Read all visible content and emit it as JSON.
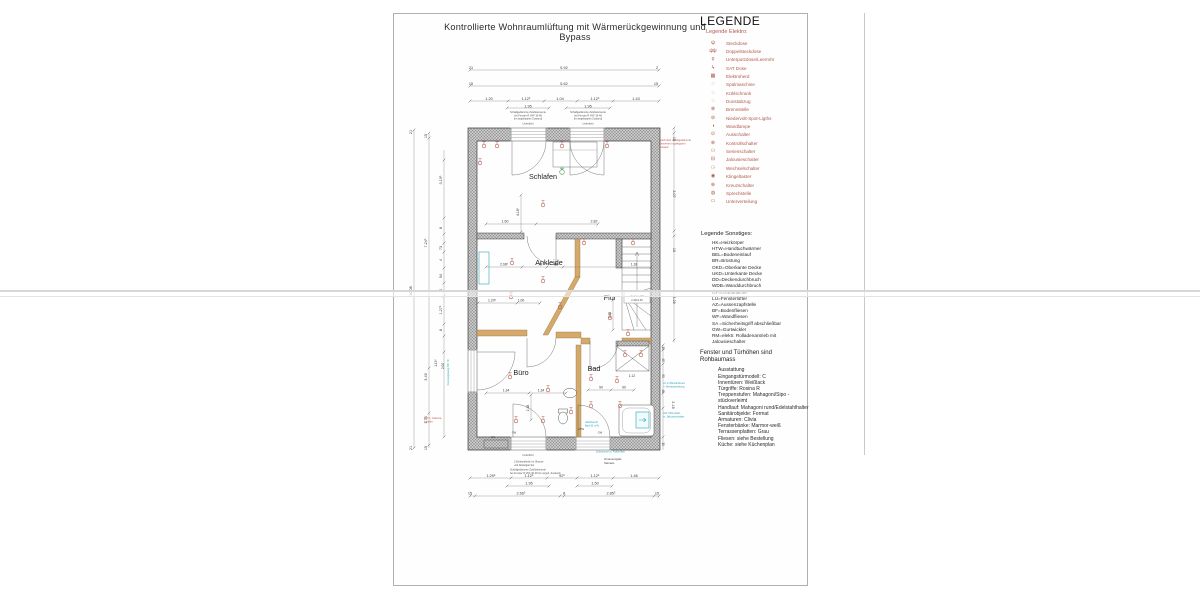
{
  "sheet": {
    "title": "Kontrollierte Wohnraumlüftung mit Wärmerückgewinnung und Bypass"
  },
  "legend": {
    "heading": "LEGENDE",
    "elektro_heading": "Legende Elektro:",
    "elektro_color": "#b0584c",
    "elektro_items": [
      {
        "symbol": "ψ",
        "label": "Steckdose"
      },
      {
        "symbol": "ψψ",
        "label": "Doppelsteckdose"
      },
      {
        "symbol": "ϙ",
        "label": "Unterputzdose/Leerrohr"
      },
      {
        "symbol": "ϟ",
        "label": "SAT Dose"
      },
      {
        "symbol": "▦",
        "label": "Elektroherd"
      },
      {
        "symbol": "◌",
        "label": "Spülmaschine"
      },
      {
        "symbol": "◌",
        "label": "Kühlschrank"
      },
      {
        "symbol": "◌",
        "label": "Dunstabzug"
      },
      {
        "symbol": "⊗",
        "label": "Brennstelle"
      },
      {
        "symbol": "⊘",
        "label": "Niedervolt-Spot-Ligths"
      },
      {
        "symbol": "◑",
        "label": "Wandlampe"
      },
      {
        "symbol": "⊙",
        "label": "Ausschalter"
      },
      {
        "symbol": "⊛",
        "label": "Kontrollschalter"
      },
      {
        "symbol": "⚇",
        "label": "Serienschalter"
      },
      {
        "symbol": "⊟",
        "label": "Jalousieschalter"
      },
      {
        "symbol": "⚆",
        "label": "Wechselschalter"
      },
      {
        "symbol": "◉",
        "label": "Klingeltaster"
      },
      {
        "symbol": "⊕",
        "label": "Kreuzschalter"
      },
      {
        "symbol": "◍",
        "label": "Sprechstelle"
      },
      {
        "symbol": "▭",
        "label": "Unterverteilung"
      }
    ],
    "sonstiges_heading": "Legende Sonstiges:",
    "sonstiges_items": [
      "HK=Heizkörper",
      "HTW=Handtuchwärmer",
      "BEL=Bodeneinlauf",
      "BR=Brüstung",
      "OKD=Oberkante Decke",
      "UKD=Unterkante Decke",
      "DD=Deckendurchbruch",
      "WDB=Wanddurchbruch",
      "GF=Grundfläche",
      "LÜ=Fensterlüfter",
      "AZ=Aussenzapfstelle",
      "BF=Bodenfliesen",
      "WF=Wandfliesen",
      "SA =Sicherheitsgriff abschließbar",
      "GW=Gurtwickler",
      "RM=elektr. Rolladenantrieb mit Jalousieschalter"
    ],
    "note": "Fenster und Türhöhen sind Rohbaumass",
    "ausstattung_heading": "Ausstattung",
    "ausstattung_items": [
      "Eingangstürmodell: C",
      "Innentüren: Weißlack",
      "Türgriffe: Rosina R",
      "Treppenstufen: Mahagoni/Sipo - stückverleimt",
      "Handlauf: Mahagoni rund/Edelstahlhalter",
      "Sanitärobjekte: Format",
      "Armaturen: Clivia",
      "Fensterbänke: Marmor-weiß",
      "Terrassenplatten: Grau",
      "Fliesen: siehe Bestellung",
      "Küche: siehe Küchenplan"
    ]
  },
  "plan": {
    "rooms": [
      "Schlafen",
      "Ankleide",
      "Flur",
      "Büro",
      "Bad"
    ],
    "stair_note": "Decken-DB 2.40x1.25",
    "labels": [
      {
        "t": "21",
        "x": 471,
        "y": 69
      },
      {
        "t": "5.92",
        "x": 564,
        "y": 69
      },
      {
        "t": "2",
        "x": 657,
        "y": 69
      },
      {
        "t": "15",
        "x": 471,
        "y": 85
      },
      {
        "t": "5.62",
        "x": 564,
        "y": 85
      },
      {
        "t": "15",
        "x": 656,
        "y": 85
      },
      {
        "t": "1.20",
        "x": 489,
        "y": 100
      },
      {
        "t": "1.12⁵",
        "x": 526,
        "y": 100
      },
      {
        "t": "1.04",
        "x": 560,
        "y": 100
      },
      {
        "t": "1.12⁵",
        "x": 595,
        "y": 100
      },
      {
        "t": "1.43",
        "x": 636,
        "y": 100
      },
      {
        "t": "1.95",
        "x": 528,
        "y": 107.5
      },
      {
        "t": "1.95",
        "x": 588,
        "y": 107.5
      },
      {
        "t": "Schallgedämmte Zuluftelemente",
        "x": 528,
        "y": 113,
        "s": 2.5,
        "c": "#555"
      },
      {
        "t": "bei Fenster R VKF 36 48",
        "x": 528,
        "y": 116.3,
        "s": 2.5,
        "c": "#555"
      },
      {
        "t": "(im angekippten Zustand)",
        "x": 528,
        "y": 119.6,
        "s": 2.5,
        "c": "#555"
      },
      {
        "t": "Unterlicht",
        "x": 528,
        "y": 124.5,
        "s": 2.6,
        "c": "#555"
      },
      {
        "t": "Schallgedämmte Zuluftelemente",
        "x": 588,
        "y": 113,
        "s": 2.5,
        "c": "#555"
      },
      {
        "t": "bei Fenster R VKF 36 48",
        "x": 588,
        "y": 116.3,
        "s": 2.5,
        "c": "#555"
      },
      {
        "t": "(im angekippten Zustand)",
        "x": 588,
        "y": 119.6,
        "s": 2.5,
        "c": "#555"
      },
      {
        "t": "Unterlicht",
        "x": 588,
        "y": 124.5,
        "s": 2.6,
        "c": "#555"
      },
      {
        "t": "Zuluft über schallgedämmte",
        "x": 659,
        "y": 141,
        "s": 2.6,
        "c": "#b5584d",
        "a": "start"
      },
      {
        "t": "Elemente im gekippten",
        "x": 659,
        "y": 144.5,
        "s": 2.6,
        "c": "#b5584d",
        "a": "start"
      },
      {
        "t": "Zustand",
        "x": 659,
        "y": 148,
        "s": 2.6,
        "c": "#b5584d",
        "a": "start"
      },
      {
        "t": "Schlafen",
        "x": 543,
        "y": 179,
        "s": 7.2,
        "c": "#1e1e1e"
      },
      {
        "t": "Ankleide",
        "x": 549,
        "y": 265,
        "s": 7.2,
        "c": "#1e1e1e"
      },
      {
        "t": "Flur",
        "x": 610,
        "y": 300,
        "s": 7.2,
        "c": "#1e1e1e"
      },
      {
        "t": "Büro",
        "x": 521,
        "y": 375,
        "s": 7.2,
        "c": "#1e1e1e"
      },
      {
        "t": "Bad",
        "x": 594,
        "y": 371,
        "s": 7.2,
        "c": "#1e1e1e"
      },
      {
        "t": "1.60",
        "x": 505,
        "y": 222.5,
        "s": 3.6
      },
      {
        "t": "2.82",
        "x": 594,
        "y": 222.5,
        "s": 3.6
      },
      {
        "t": "4.18⁵",
        "x": 519,
        "y": 212,
        "s": 3.4,
        "r": -90
      },
      {
        "t": "2.08⁵",
        "x": 504,
        "y": 265.5,
        "s": 3.4
      },
      {
        "t": "78",
        "x": 540,
        "y": 265.5,
        "s": 3.4
      },
      {
        "t": "86",
        "x": 556,
        "y": 265.5,
        "s": 3.4
      },
      {
        "t": "1.18",
        "x": 634,
        "y": 265.5,
        "s": 3.4
      },
      {
        "t": "1.20⁵",
        "x": 492,
        "y": 301.5,
        "s": 3.4
      },
      {
        "t": "1.00",
        "x": 521,
        "y": 301.5,
        "s": 3.4
      },
      {
        "t": "1.53",
        "x": 611,
        "y": 315,
        "s": 3.4,
        "r": -90
      },
      {
        "t": "1.34",
        "x": 506,
        "y": 391.5,
        "s": 3.4
      },
      {
        "t": "1.34",
        "x": 541,
        "y": 391.5,
        "s": 3.4
      },
      {
        "t": "2.38",
        "x": 529,
        "y": 408,
        "s": 3.4,
        "r": -90
      },
      {
        "t": "90",
        "x": 601,
        "y": 388.5,
        "s": 3.4
      },
      {
        "t": "90",
        "x": 624,
        "y": 388.5,
        "s": 3.4
      },
      {
        "t": "1.12",
        "x": 632,
        "y": 377,
        "s": 3.2
      },
      {
        "t": "Decken-DB",
        "x": 637,
        "y": 297,
        "s": 2.6,
        "c": "#444"
      },
      {
        "t": "2.40x1.25",
        "x": 637,
        "y": 300.8,
        "s": 2.6,
        "c": "#444"
      },
      {
        "t": "HK",
        "x": 493,
        "y": 438,
        "s": 3,
        "c": "#333"
      },
      {
        "t": "GW",
        "x": 514,
        "y": 433.5,
        "s": 2.6,
        "c": "#444"
      },
      {
        "t": "GW",
        "x": 600,
        "y": 433.5,
        "s": 2.6,
        "c": "#444"
      },
      {
        "t": "HTW",
        "x": 581,
        "y": 430,
        "s": 2.6,
        "c": "#333"
      },
      {
        "t": "Abluftventil",
        "x": 585,
        "y": 423,
        "s": 2.6,
        "c": "#2aa6b8",
        "a": "start"
      },
      {
        "t": "Bad 60 m³/h",
        "x": 585,
        "y": 426.5,
        "s": 2.6,
        "c": "#2aa6b8",
        "a": "start"
      },
      {
        "t": "Zuluftventil m. Pollenfilter",
        "x": 596,
        "y": 452.5,
        "s": 2.6,
        "c": "#2aa6b8",
        "a": "start"
      },
      {
        "t": "Unterlicht",
        "x": 528,
        "y": 456,
        "s": 2.6,
        "c": "#555"
      },
      {
        "t": "2 Einhandhebel m. Brause",
        "x": 514,
        "y": 462.5,
        "s": 2.5,
        "c": "#555",
        "a": "start"
      },
      {
        "t": "und Ablaufgarnitur",
        "x": 514,
        "y": 466,
        "s": 2.5,
        "c": "#555",
        "a": "start"
      },
      {
        "t": "Schallgedämmte Zuluftelemente",
        "x": 510,
        "y": 470.5,
        "s": 2.5,
        "c": "#555",
        "a": "start"
      },
      {
        "t": "bei Fenster R VKF 36 48 (im angek. Zustand)",
        "x": 510,
        "y": 474,
        "s": 2.5,
        "c": "#555",
        "a": "start"
      },
      {
        "t": "Ornamentglas",
        "x": 604,
        "y": 460,
        "s": 2.8,
        "c": "#444",
        "a": "start"
      },
      {
        "t": "Satinato",
        "x": 604,
        "y": 463.8,
        "s": 2.8,
        "c": "#444",
        "a": "start"
      },
      {
        "t": "1.29⁵",
        "x": 491,
        "y": 477
      },
      {
        "t": "1.12⁵",
        "x": 529,
        "y": 477
      },
      {
        "t": "92⁵",
        "x": 562,
        "y": 477
      },
      {
        "t": "1.12⁵",
        "x": 595,
        "y": 477
      },
      {
        "t": "1.46",
        "x": 634,
        "y": 477
      },
      {
        "t": "1.95",
        "x": 529,
        "y": 484.5
      },
      {
        "t": "1.50",
        "x": 595,
        "y": 484.5
      },
      {
        "t": "15",
        "x": 470,
        "y": 494.5
      },
      {
        "t": "2.66⁵",
        "x": 521,
        "y": 494.5
      },
      {
        "t": "8",
        "x": 564,
        "y": 494.5
      },
      {
        "t": "2.85⁵",
        "x": 611,
        "y": 494.5
      },
      {
        "t": "15",
        "x": 657,
        "y": 494.5
      },
      {
        "t": "21",
        "x": 412,
        "y": 132,
        "r": -90
      },
      {
        "t": "10.08",
        "x": 412,
        "y": 291,
        "r": -90
      },
      {
        "t": "21",
        "x": 412,
        "y": 448,
        "r": -90
      },
      {
        "t": "15",
        "x": 427,
        "y": 136,
        "r": -90
      },
      {
        "t": "7.24⁵",
        "x": 427,
        "y": 243,
        "r": -90
      },
      {
        "t": "3.49",
        "x": 427,
        "y": 377,
        "r": -90
      },
      {
        "t": "1.74",
        "x": 427,
        "y": 420,
        "r": -90
      },
      {
        "t": "15",
        "x": 427,
        "y": 448,
        "r": -90
      },
      {
        "t": "3.10⁵",
        "x": 442,
        "y": 180,
        "r": -90
      },
      {
        "t": "8",
        "x": 442,
        "y": 228,
        "r": -90
      },
      {
        "t": "73",
        "x": 442,
        "y": 248,
        "r": -90
      },
      {
        "t": "4",
        "x": 442,
        "y": 260,
        "r": -90
      },
      {
        "t": "94",
        "x": 442,
        "y": 276,
        "r": -90
      },
      {
        "t": "4",
        "x": 442,
        "y": 290,
        "r": -90
      },
      {
        "t": "1.27⁵",
        "x": 442,
        "y": 310,
        "r": -90
      },
      {
        "t": "8",
        "x": 442,
        "y": 330,
        "r": -90
      },
      {
        "t": "1.13⁵",
        "x": 437,
        "y": 363,
        "r": -90,
        "s": 3.2
      },
      {
        "t": "2.00",
        "x": 444,
        "y": 366,
        "r": -90,
        "s": 3.2
      },
      {
        "t": "RM m. Jalousie-",
        "x": 424,
        "y": 419,
        "s": 2.5,
        "c": "#b5584d",
        "a": "start"
      },
      {
        "t": "schalter",
        "x": 424,
        "y": 422.3,
        "s": 2.5,
        "c": "#b5584d",
        "a": "start"
      },
      {
        "t": "Festverglasung BR 73⁵",
        "x": 449,
        "y": 372,
        "s": 2.6,
        "c": "#2aa6b8",
        "r": -90
      },
      {
        "t": "15",
        "x": 673,
        "y": 139,
        "r": 90
      },
      {
        "t": "3.07",
        "x": 673,
        "y": 194,
        "r": 90
      },
      {
        "t": "15",
        "x": 673,
        "y": 250,
        "r": 90
      },
      {
        "t": "3.26",
        "x": 673,
        "y": 300,
        "r": 90
      },
      {
        "t": "15",
        "x": 662,
        "y": 348,
        "r": 90,
        "s": 3.2
      },
      {
        "t": "45",
        "x": 662,
        "y": 360,
        "r": 90,
        "s": 3.2
      },
      {
        "t": "90",
        "x": 662,
        "y": 376,
        "r": 90,
        "s": 3.2
      },
      {
        "t": "46",
        "x": 662,
        "y": 391,
        "r": 90,
        "s": 3.2
      },
      {
        "t": "2.18",
        "x": 672,
        "y": 405,
        "r": 90
      },
      {
        "t": "15",
        "x": 662,
        "y": 444,
        "r": 90,
        "s": 3.2
      },
      {
        "t": "LÜ im Blendrahmen",
        "x": 663,
        "y": 384,
        "s": 2.5,
        "c": "#2aa6b8",
        "a": "start"
      },
      {
        "t": "n. Westausrichtung",
        "x": 663,
        "y": 387.5,
        "s": 2.5,
        "c": "#2aa6b8",
        "a": "start"
      },
      {
        "t": "GW / RM elektr.",
        "x": 663,
        "y": 414,
        "s": 2.5,
        "c": "#2aa6b8",
        "a": "start"
      },
      {
        "t": "m. Jalousieschalter",
        "x": 663,
        "y": 417.5,
        "s": 2.5,
        "c": "#2aa6b8",
        "a": "start"
      }
    ],
    "symbols": [
      {
        "x": 484,
        "y": 146
      },
      {
        "x": 497,
        "y": 146
      },
      {
        "x": 480,
        "y": 163
      },
      {
        "x": 543,
        "y": 205
      },
      {
        "x": 562,
        "y": 146
      },
      {
        "x": 607,
        "y": 146
      },
      {
        "x": 512,
        "y": 263
      },
      {
        "x": 543,
        "y": 281
      },
      {
        "x": 511,
        "y": 297
      },
      {
        "x": 560,
        "y": 307
      },
      {
        "x": 584,
        "y": 243
      },
      {
        "x": 610,
        "y": 318
      },
      {
        "x": 633,
        "y": 243
      },
      {
        "x": 628,
        "y": 334
      },
      {
        "x": 510,
        "y": 377
      },
      {
        "x": 548,
        "y": 390
      },
      {
        "x": 516,
        "y": 421
      },
      {
        "x": 543,
        "y": 421
      },
      {
        "x": 591,
        "y": 379
      },
      {
        "x": 617,
        "y": 381
      },
      {
        "x": 591,
        "y": 406
      },
      {
        "x": 620,
        "y": 406
      },
      {
        "x": 625,
        "y": 355
      },
      {
        "x": 641,
        "y": 355
      },
      {
        "x": 571,
        "y": 412
      }
    ],
    "colors": {
      "electrical": "#b5584d",
      "annotation_teal": "#2aa6b8",
      "wall_tan": "#d4a96c"
    }
  }
}
